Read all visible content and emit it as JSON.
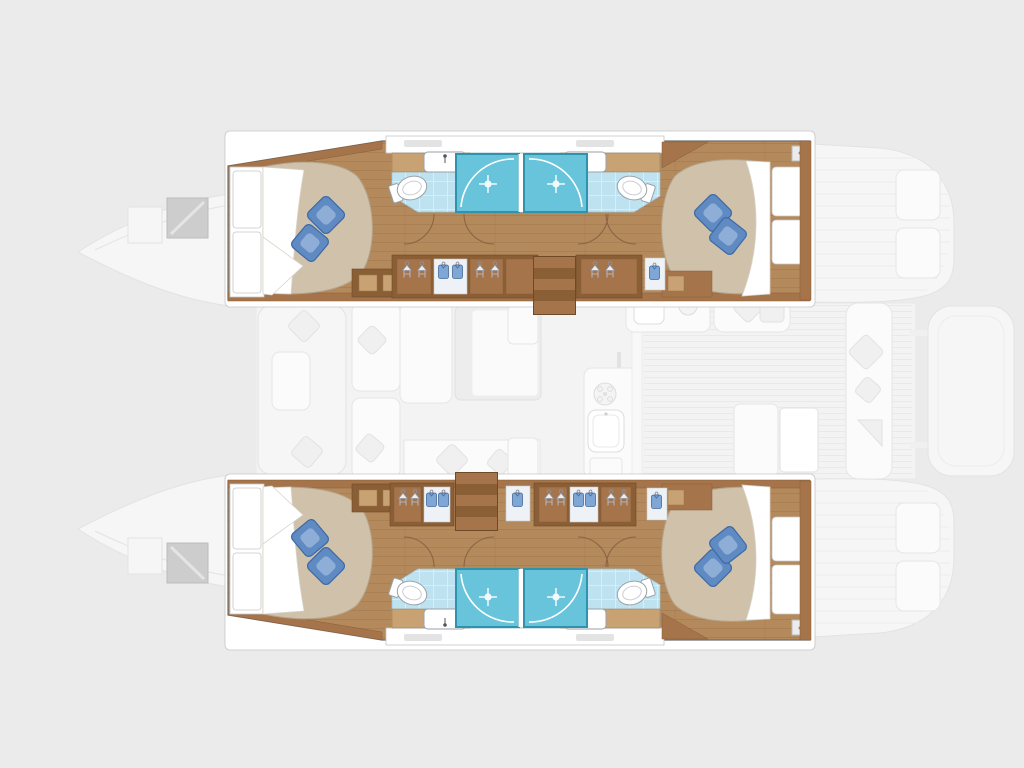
{
  "plan": {
    "type": "yacht-floor-plan",
    "vessel": "catamaran",
    "orientation": "bow-left",
    "totals": {
      "hulls": 2,
      "cabins": 4,
      "bathrooms": 4,
      "showers": 4,
      "double_beds": 4,
      "pillows": 8,
      "companionway_stairs": 2
    },
    "hulls": [
      {
        "name": "port-hull",
        "position": "top",
        "features": [
          "bow-deck",
          "deck-hatch",
          "forward-cabin",
          "double-bed",
          "blue-pillows",
          "bathroom",
          "shower-cabin",
          "toilet",
          "washbasin",
          "door-swing",
          "wardrobe-hangers",
          "wardrobe-clothes",
          "companionway-stairs",
          "aft-cabin",
          "nightstand",
          "stern-deck"
        ]
      },
      {
        "name": "starboard-hull",
        "position": "bottom",
        "features": [
          "bow-deck",
          "deck-hatch",
          "forward-cabin",
          "double-bed",
          "blue-pillows",
          "bathroom",
          "shower-cabin",
          "toilet",
          "washbasin",
          "door-swing",
          "wardrobe-hangers",
          "wardrobe-clothes",
          "companionway-stairs",
          "aft-cabin",
          "nightstand",
          "stern-deck"
        ]
      }
    ],
    "saloon": {
      "render_style": "faint-ghosted",
      "features": [
        "forward-cockpit-seating",
        "forward-cockpit-table",
        "saloon-sofa",
        "dining-table",
        "galley-counter",
        "galley-sink",
        "stove-burner",
        "galley-island",
        "mast-partition",
        "cockpit-teak-deck",
        "cockpit-bench",
        "cockpit-cushions",
        "cockpit-table",
        "swim-platform"
      ]
    },
    "icons": [
      "hanger-icon",
      "clothes-icon",
      "shower-sparkle-icon",
      "faucet-icon",
      "burner-icon"
    ]
  },
  "colors": {
    "page_bg": "#ebebeb",
    "floor_wood": "#b4895c",
    "wood_dark": "#8a5f36",
    "wood_mid": "#a5744a",
    "wood_light": "#c9a273",
    "mattress": "#cfc1aa",
    "pillow": "#5f8ac2",
    "pillow_dark": "#3d69a6",
    "pillow_light": "#9db9de",
    "bath_floor": "#bfe2f0",
    "shower": "#68c4db",
    "shower_border": "#2f93ae",
    "faint_fill": "#f6f6f6",
    "faint_stroke": "#e3e3e3",
    "line_gray": "#c6c6c6",
    "hull_outline": "#6f6f6f"
  }
}
